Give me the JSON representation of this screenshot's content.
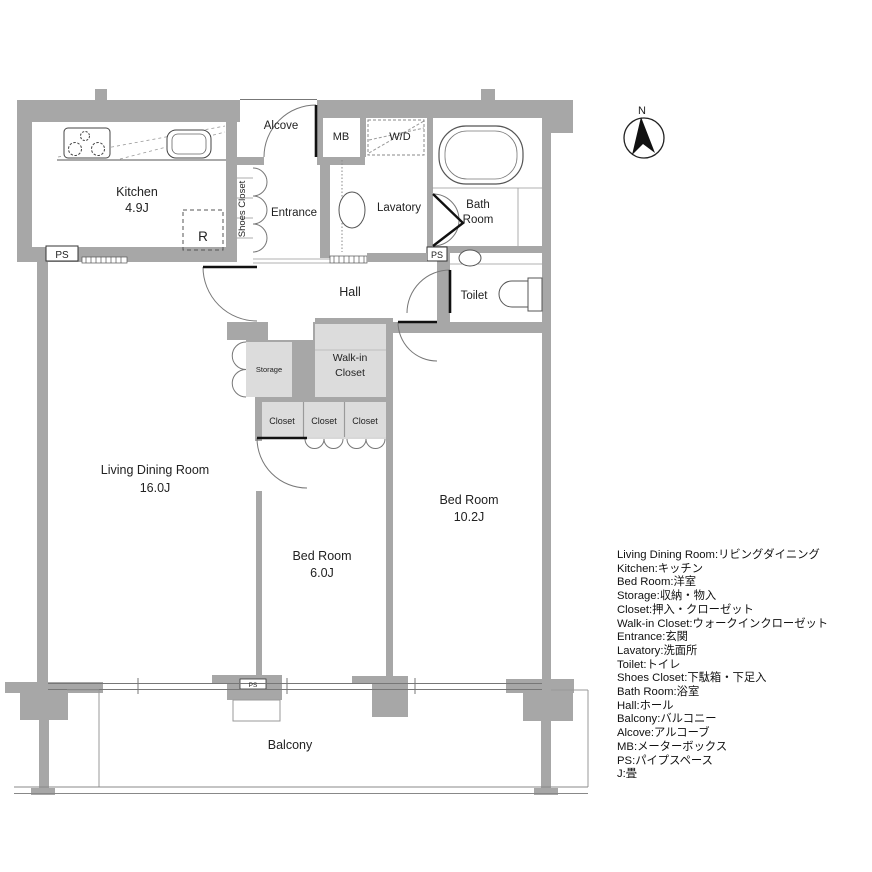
{
  "plan": {
    "rooms": {
      "kitchen": {
        "label": "Kitchen",
        "size": "4.9J"
      },
      "living_dining": {
        "label": "Living Dining Room",
        "size": "16.0J"
      },
      "bedroom_small": {
        "label": "Bed Room",
        "size": "6.0J"
      },
      "bedroom_large": {
        "label": "Bed Room",
        "size": "10.2J"
      },
      "hall": {
        "label": "Hall"
      },
      "entrance": {
        "label": "Entrance"
      },
      "alcove": {
        "label": "Alcove"
      },
      "lavatory": {
        "label": "Lavatory"
      },
      "bath": {
        "line1": "Bath",
        "line2": "Room"
      },
      "toilet": {
        "label": "Toilet"
      },
      "shoes_closet": {
        "label": "Shoes Closet"
      },
      "storage": {
        "label": "Storage"
      },
      "walk_in_closet": {
        "line1": "Walk-in",
        "line2": "Closet"
      },
      "closet1": {
        "label": "Closet"
      },
      "closet2": {
        "label": "Closet"
      },
      "closet3": {
        "label": "Closet"
      },
      "balcony": {
        "label": "Balcony"
      }
    },
    "fixtures": {
      "refrigerator": "R",
      "washer_dryer": "W/D",
      "meter_box": "MB"
    },
    "ps_kitchen": "PS",
    "ps_bath": "PS",
    "ps_balcony": "PS",
    "compass_north": "N",
    "colors": {
      "wall": "#a7a7a7",
      "closet_fill": "#dcdcdc",
      "line": "#777777",
      "door": "#111111"
    }
  },
  "legend": {
    "lines": [
      "Living Dining Room:リビングダイニング",
      "Kitchen:キッチン",
      "Bed Room:洋室",
      "Storage:収納・物入",
      "Closet:押入・クローゼット",
      "Walk-in Closet:ウォークインクローゼット",
      "Entrance:玄関",
      "Lavatory:洗面所",
      "Toilet:トイレ",
      "Shoes Closet:下駄箱・下足入",
      "Bath Room:浴室",
      "Hall:ホール",
      "Balcony:バルコニー",
      "Alcove:アルコーブ",
      "MB:メーターボックス",
      "PS:パイプスペース",
      "J:畳"
    ]
  }
}
